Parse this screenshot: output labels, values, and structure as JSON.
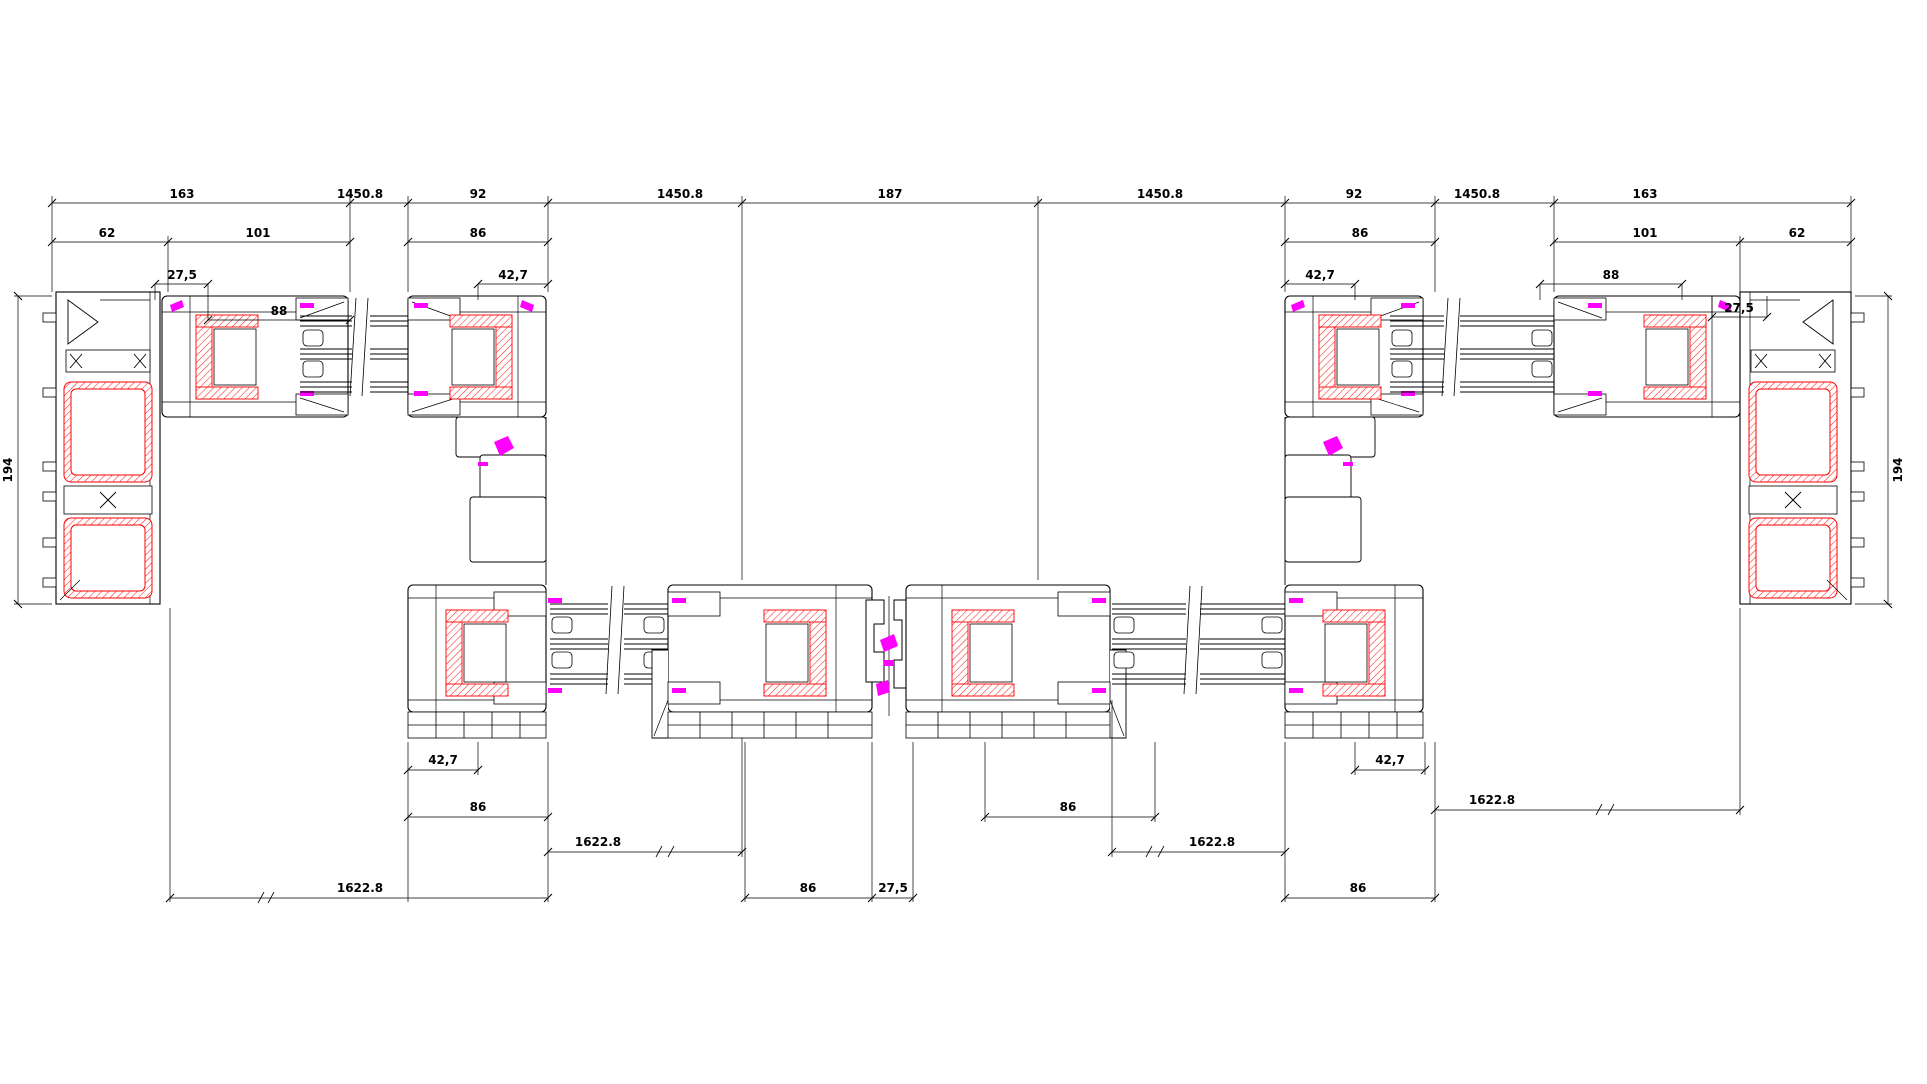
{
  "drawing": {
    "kind": "window-profile-cross-section",
    "background": "#ffffff",
    "colors": {
      "line": "#000000",
      "steel_reinforcement": "#ff0000",
      "gasket": "#ff00ff"
    }
  },
  "dims": {
    "top1": [
      "163",
      "1450.8",
      "92",
      "1450.8",
      "187",
      "1450.8",
      "92",
      "1450.8",
      "163"
    ],
    "top2": [
      "62",
      "101",
      "86",
      "86",
      "101",
      "62"
    ],
    "detail": {
      "l_275": "27,5",
      "l_88": "88",
      "l_427": "42,7",
      "r_427": "42,7",
      "r_88": "88",
      "r_275": "27,5"
    },
    "bottom": {
      "l_427": "42,7",
      "l_86": "86",
      "l_1622_mid": "1622.8",
      "l_1622_out": "1622.8",
      "c_86": "86",
      "c_275": "27,5",
      "rc_86": "86",
      "r_1622_mid": "1622.8",
      "r_427": "42,7",
      "r_86": "86",
      "r_1622_out": "1622.8"
    },
    "side": {
      "left": "194",
      "right": "194"
    }
  }
}
